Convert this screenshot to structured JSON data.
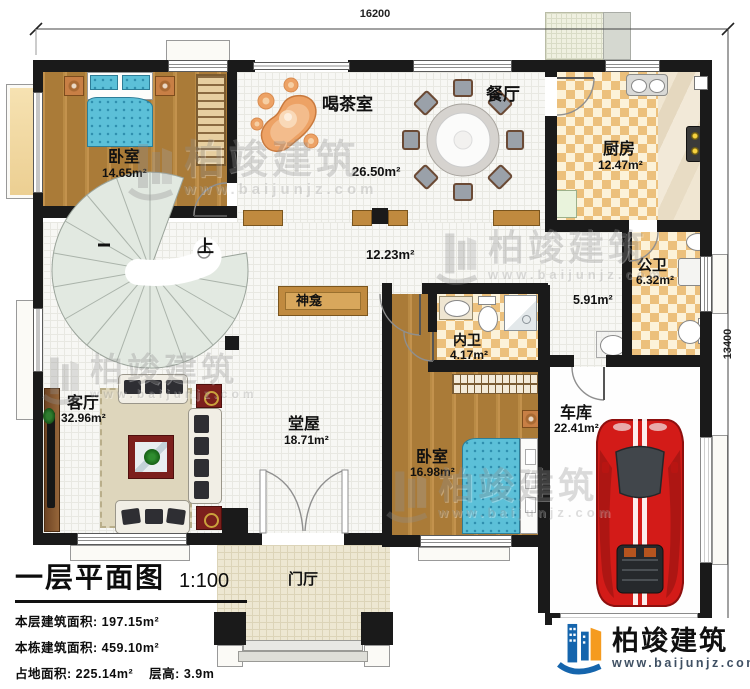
{
  "dimensions": {
    "width": "16200",
    "height": "13400"
  },
  "rooms": {
    "bedroom1": {
      "name": "卧室",
      "area": "14.65m²"
    },
    "tea_room": {
      "name": "喝茶室",
      "area": "26.50m²"
    },
    "dining": {
      "name": "餐厅"
    },
    "kitchen": {
      "name": "厨房",
      "area": "12.47m²"
    },
    "public_bath": {
      "name": "公卫",
      "area": "6.32m²"
    },
    "corridor": {
      "area": "5.91m²"
    },
    "hall": {
      "area": "12.23m²"
    },
    "shrine": {
      "name": "神龛"
    },
    "stairs": {
      "up_label": "上"
    },
    "inner_bath": {
      "name": "内卫",
      "area": "4.17m²"
    },
    "bedroom2": {
      "name": "卧室",
      "area": "16.98m²"
    },
    "garage": {
      "name": "车库",
      "area": "22.41m²"
    },
    "living": {
      "name": "客厅",
      "area": "32.96m²"
    },
    "main_hall": {
      "name": "堂屋",
      "area": "18.71m²"
    },
    "foyer": {
      "name": "门厅"
    }
  },
  "title_block": {
    "title": "一层平面图",
    "scale": "1:100",
    "stats": [
      {
        "label": "本层建筑面积:",
        "value": "197.15m²"
      },
      {
        "label": "本栋建筑面积:",
        "value": "459.10m²"
      },
      {
        "label": "占地面积:",
        "value": "225.14m²"
      },
      {
        "label": "层高:",
        "value": "3.9m"
      }
    ]
  },
  "branding": {
    "logo_text": "柏竣建筑",
    "website": "www.baijunjz.com"
  },
  "watermark": {
    "text": "柏竣建筑",
    "website": "www.baijunjz.com"
  },
  "colors": {
    "wall": "#1a1a1a",
    "logo_blue": "#1565ad",
    "logo_orange": "#f59b1f",
    "car_red": "#d31b18"
  }
}
